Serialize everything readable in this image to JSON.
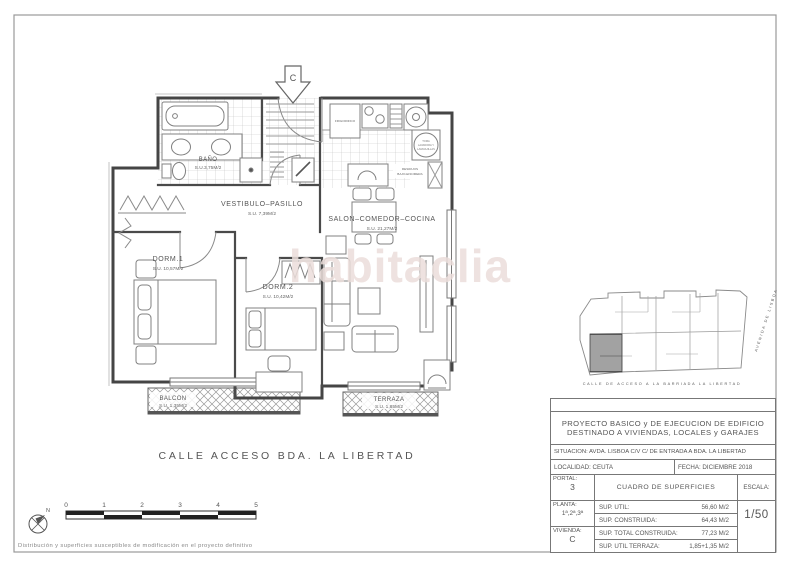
{
  "drawing": {
    "watermark": "habitaclia",
    "entry_letter": "C",
    "street_label": "CALLE ACCESO BDA. LA LIBERTAD",
    "disclaimer": "Distribución y superficies susceptibles de modificación en el proyecto definitivo",
    "north_label": "N"
  },
  "rooms": {
    "bano": {
      "name": "BAÑO",
      "area": "S.U.3,75M/2"
    },
    "vestibulo": {
      "name": "VESTIBULO–PASILLO",
      "area": "S.U. 7,39M/2"
    },
    "salon": {
      "name": "SALON–COMEDOR–COCINA",
      "area": "S.U. 21,27M/2"
    },
    "dorm1": {
      "name": "DORM.1",
      "area": "S.U. 10,57M/2"
    },
    "dorm2": {
      "name": "DORM.2",
      "area": "S.U. 10,42M/2"
    },
    "balcon": {
      "name": "BALCON",
      "area": "S.U. 1,35M/2"
    },
    "terraza": {
      "name": "TERRAZA",
      "area": "S.U. 1,85M/2"
    }
  },
  "kitchen": {
    "fridge": "FRIGORIFICO",
    "residuos_line1": "RESIDUOS",
    "residuos_line2": "BAJO-ENCIMERA",
    "appliance_line1": "TOMA",
    "appliance_line2": "LAVADORA Y",
    "appliance_line3": "LAVAVAJILLAS"
  },
  "scale_bar": {
    "ticks": [
      "0",
      "1",
      "2",
      "3",
      "4",
      "5"
    ]
  },
  "site_plan": {
    "street_label": "CALLE DE ACCESO A LA BARRIADA LA LIBERTAD",
    "avenue_label": "AVENIDA DE LISBOA"
  },
  "title_block": {
    "project_title_line1": "PROYECTO BASICO y DE EJECUCION DE EDIFICIO",
    "project_title_line2": "DESTINADO A VIVIENDAS, LOCALES y GARAJES",
    "situacion": "SITUACION: AVDA. LISBOA C/V C/ DE ENTRADA A BDA. LA LIBERTAD",
    "localidad": "LOCALIDAD: CEUTA",
    "fecha": "FECHA: DICIEMBRE 2018",
    "portal_label": "PORTAL:",
    "portal_value": "3",
    "planta_label": "PLANTA:",
    "planta_value": "1ª,2ª,3ª",
    "vivienda_label": "VIVIENDA:",
    "vivienda_value": "C",
    "cuadro_title": "CUADRO DE SUPERFICIES",
    "escala_label": "ESCALA:",
    "escala_value": "1/50",
    "rows": [
      {
        "label": "SUP. UTIL:",
        "value": "56,60 M/2"
      },
      {
        "label": "SUP. CONSTRUIDA:",
        "value": "64,43 M/2"
      },
      {
        "label": "SUP. TOTAL CONSTRUIDA:",
        "value": "77,23 M/2"
      },
      {
        "label": "SUP. UTIL TERRAZA:",
        "value": "1,85+1,35 M/2"
      }
    ]
  }
}
